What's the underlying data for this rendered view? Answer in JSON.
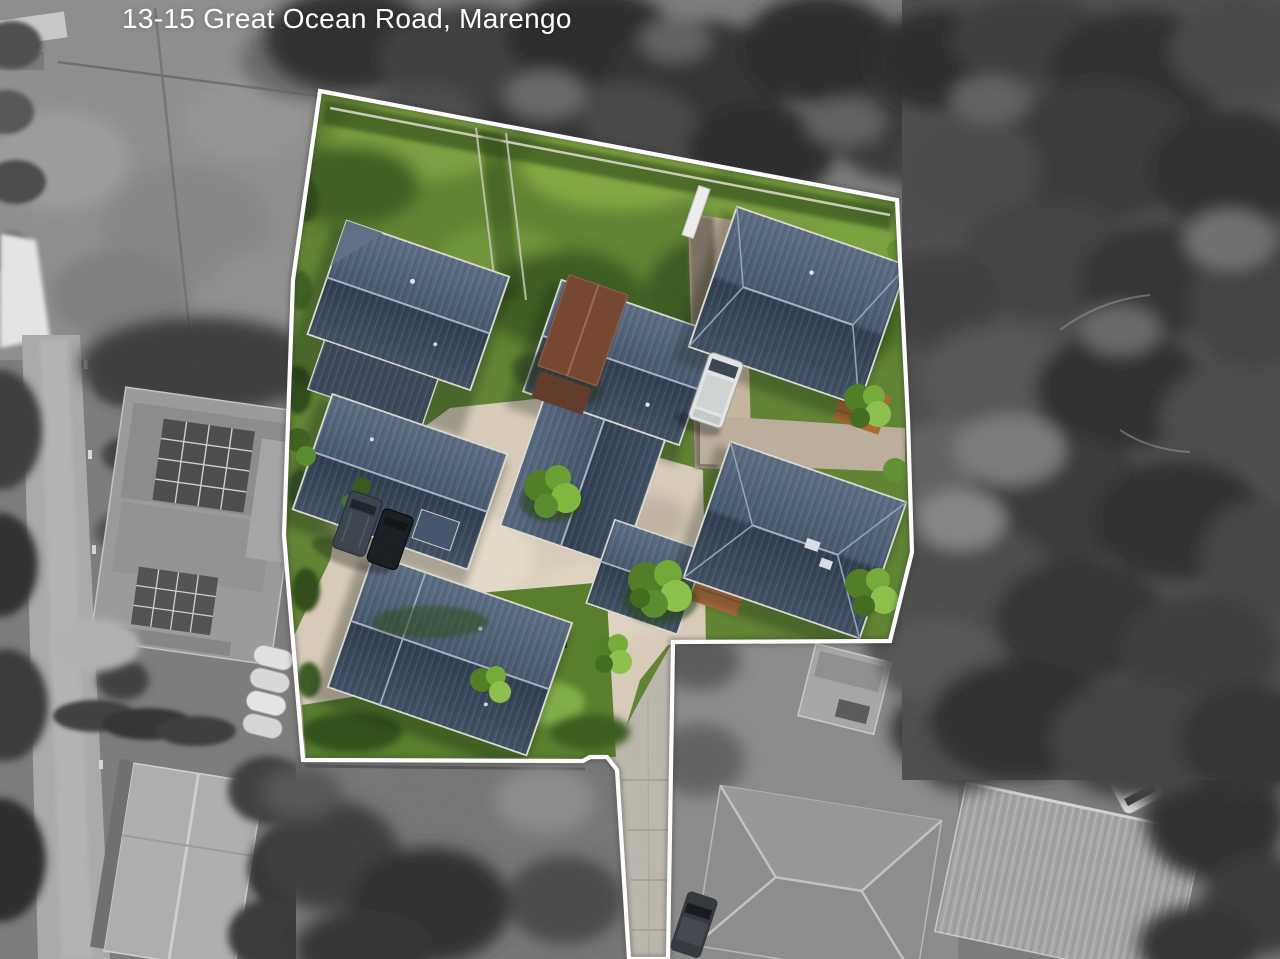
{
  "overlay": {
    "address_label": "13-15 Great Ocean Road, Marengo"
  },
  "photo": {
    "type": "aerial-drone-photograph",
    "highlight_note": "property inside white boundary shown in colour, surroundings desaturated",
    "colors": {
      "boundary_line": "#ffffff",
      "address_text": "#ffffff",
      "roof_metal": "#44546a",
      "lawn_green": "#5f8230",
      "driveway_concrete": "#d8cbb9",
      "timber_deck": "#b5703a",
      "surroundings": "#6e6e6e"
    }
  }
}
